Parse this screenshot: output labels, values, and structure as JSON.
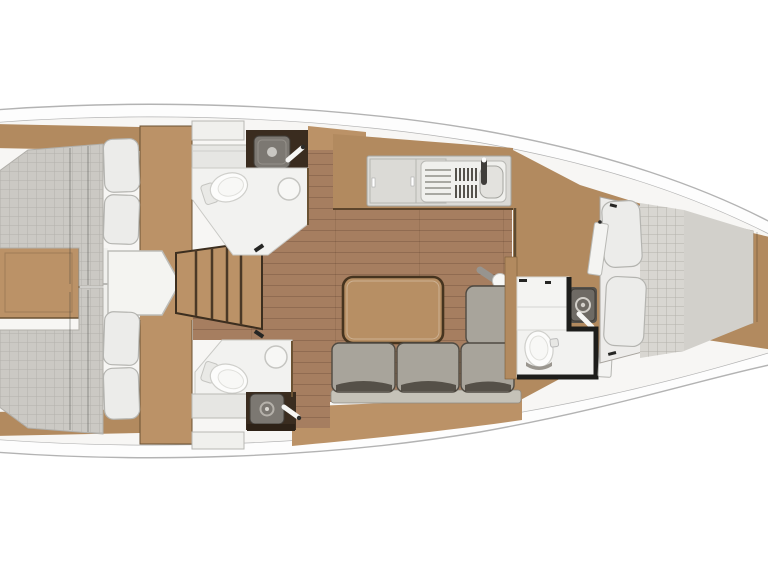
{
  "meta": {
    "kind": "sailing-yacht-interior-floor-plan",
    "orientation": "bow-right-stern-left",
    "visible_text": "none"
  },
  "colors": {
    "bg": "#ffffff",
    "hullLine": "#b3b3b3",
    "deck": "#fdfdfd",
    "base": "#f7f6f4",
    "wood": "#b28a5f",
    "woodL": "#bb9267",
    "woodDark": "#6b5233",
    "floor": "#a67e60",
    "counter": "#dbdad6",
    "panel": "#f0f0ed",
    "cabinetDark": "#3a2c1f",
    "bathFloor": "#f2f2f0",
    "fixtureWhite": "#fcfcfb",
    "sinkGray": "#7c7872",
    "mattress": "#cbc9c4",
    "sheet": "#edecea",
    "pillow": "#ececea",
    "sofa": "#a8a49b",
    "sofaLight": "#c5c2b8",
    "sofaDark": "#3a342c",
    "tableFill": "#b78f64",
    "tableBorder": "#46341f",
    "wallDark": "#1d1d1b",
    "steel": "#97948f"
  },
  "rooms": [
    {
      "id": "aft-cabin-port",
      "label": "aft-double-cabin-port",
      "fixtures": [
        "double-berth",
        "pillow",
        "pillow",
        "wardrobe"
      ]
    },
    {
      "id": "aft-cabin-starboard",
      "label": "aft-double-cabin-starboard",
      "fixtures": [
        "double-berth",
        "pillow",
        "pillow",
        "wardrobe"
      ]
    },
    {
      "id": "head-port",
      "label": "bathroom-port",
      "fixtures": [
        "toilet",
        "washbasin",
        "faucet",
        "shower-drain",
        "vanity",
        "hatch"
      ]
    },
    {
      "id": "head-starboard",
      "label": "bathroom-starboard",
      "fixtures": [
        "toilet",
        "washbasin",
        "faucet",
        "shower-drain",
        "vanity",
        "hatch"
      ]
    },
    {
      "id": "companionway",
      "label": "companionway",
      "fixtures": [
        "stairs-4-treads",
        "engine-box",
        "cabinet"
      ]
    },
    {
      "id": "galley",
      "label": "galley",
      "fixtures": [
        "cabinet-doors",
        "drainer",
        "stove-grates",
        "sink",
        "faucet"
      ]
    },
    {
      "id": "salon",
      "label": "salon",
      "fixtures": [
        "l-shaped-sofa",
        "table",
        "mast-lamp"
      ]
    },
    {
      "id": "head-forward",
      "label": "bathroom-forward",
      "fixtures": [
        "toilet",
        "washbasin",
        "faucet",
        "vanity",
        "door"
      ]
    },
    {
      "id": "forward-cabin",
      "label": "forward-v-berth-cabin",
      "fixtures": [
        "v-berth",
        "pillow",
        "pillow",
        "door"
      ]
    }
  ]
}
